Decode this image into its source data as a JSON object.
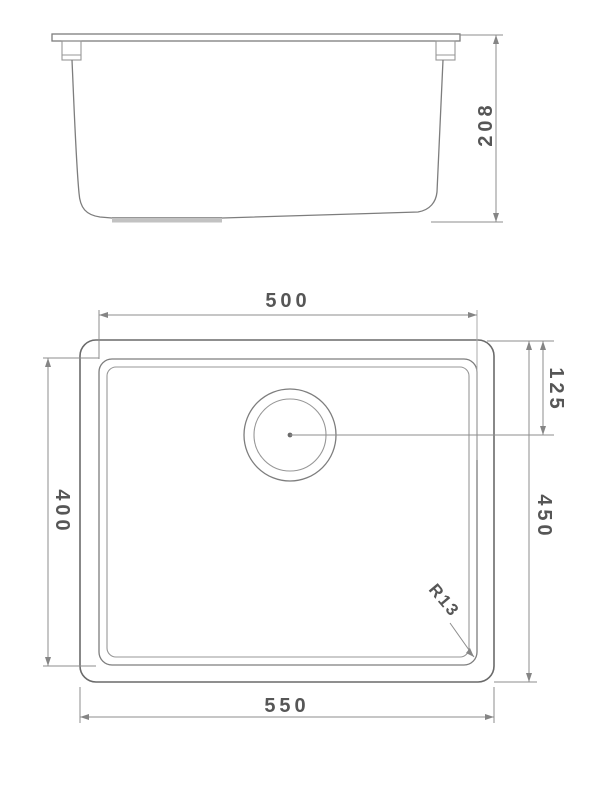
{
  "dims": {
    "side_height": "208",
    "bowl_width": "500",
    "drain_offset": "125",
    "bowl_front_to_back": "400",
    "outer_front_to_back": "450",
    "outer_width": "550",
    "corner_radius": "R13"
  },
  "colors": {
    "outline": "#6a6a6a",
    "dimension_line": "#8e8e8e",
    "text": "#565656",
    "drain_recess": "#c2c2c2",
    "background": "#ffffff"
  }
}
